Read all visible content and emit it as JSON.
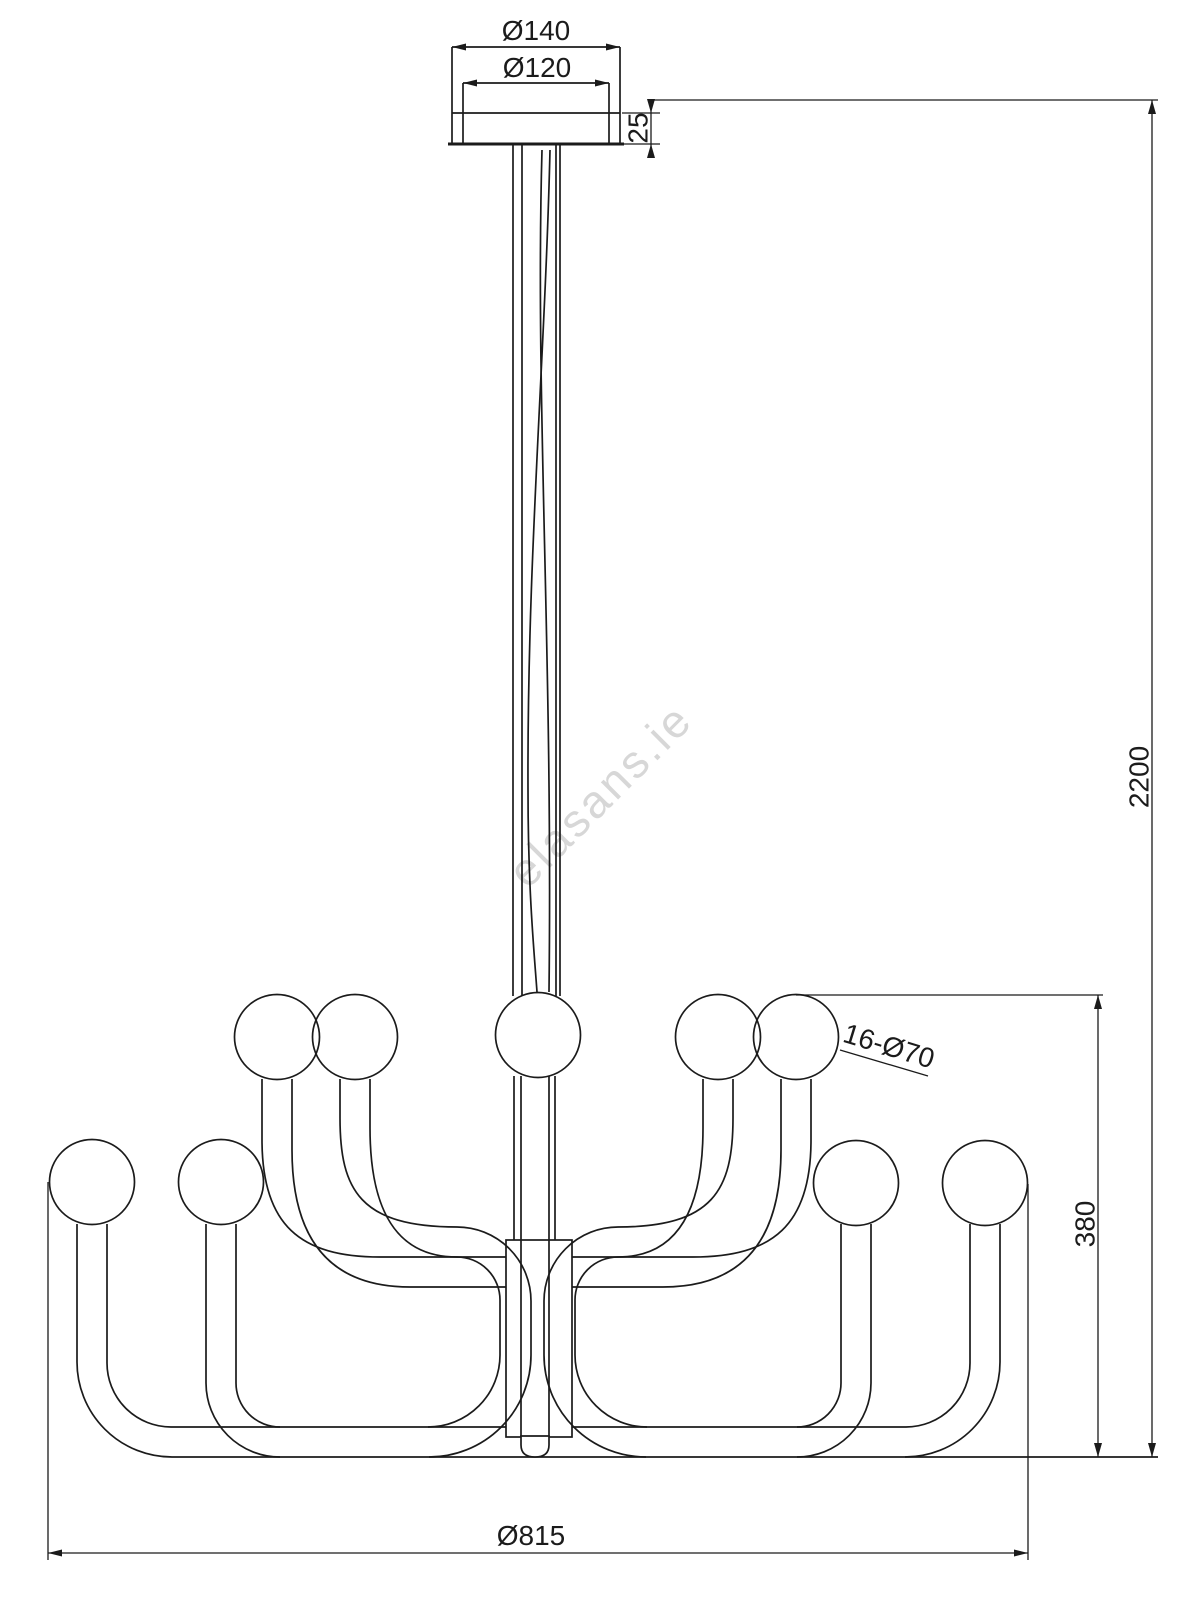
{
  "drawing": {
    "title": "chandelier-dimension-drawing",
    "watermark": "elasans.ie",
    "line_color": "#1b1b1b",
    "watermark_color": "#d7d7d7",
    "bulb_count_visible": 9,
    "dimensions": {
      "canopy_outer_diameter": "Ø140",
      "canopy_inner_diameter": "Ø120",
      "canopy_rim_height": "25",
      "total_suspension_height": "2200",
      "body_height": "380",
      "bulb_callout": "16-Ø70",
      "body_diameter": "Ø815"
    }
  }
}
